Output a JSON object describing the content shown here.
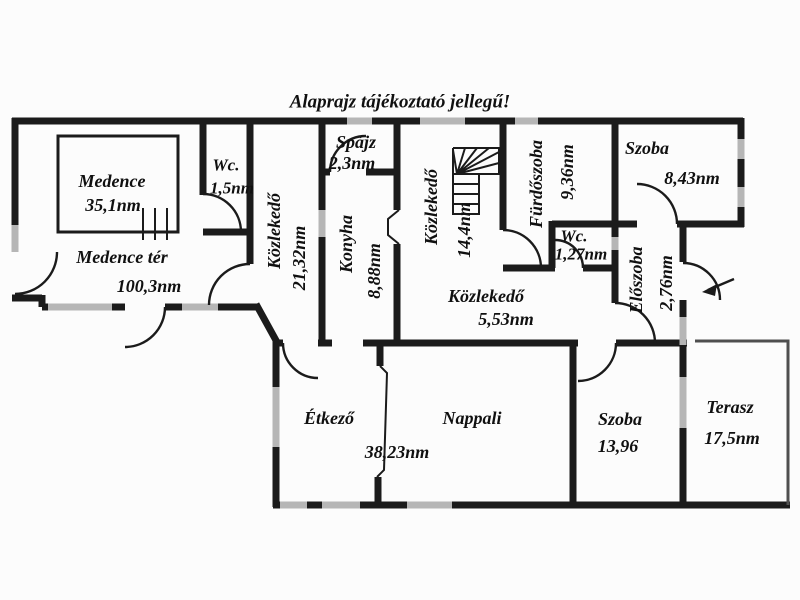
{
  "title": "Alaprajz tájékoztató jellegű!",
  "rooms": [
    {
      "name": "Medence",
      "area": "35,1nm"
    },
    {
      "name": "Medence tér",
      "area": "100,3nm"
    },
    {
      "name": "Wc.",
      "area": "1,5nm"
    },
    {
      "name": "Közlekedő",
      "area": "21,32nm"
    },
    {
      "name": "Spájz",
      "area": "2,3nm"
    },
    {
      "name": "Konyha",
      "area": "8,88nm"
    },
    {
      "name": "Közlekedő",
      "area": "14,4nm"
    },
    {
      "name": "Fürdőszoba",
      "area": "9,36nm"
    },
    {
      "name": "Wc.",
      "area": "1,27nm"
    },
    {
      "name": "Szoba",
      "area": "8,43nm"
    },
    {
      "name": "Előszoba",
      "area": "2,76nm"
    },
    {
      "name": "Közlekedő",
      "area": "5,53nm"
    },
    {
      "name": "Étkező",
      "area": ""
    },
    {
      "name": "Nappali",
      "area": "38,23nm"
    },
    {
      "name": "Szoba",
      "area": "13,96"
    },
    {
      "name": "Terasz",
      "area": "17,5nm"
    }
  ],
  "icons": {
    "stairs": "stairs-icon",
    "entrance_arrow": "entrance-arrow-icon",
    "pool_ladder": "pool-ladder-icon",
    "doors": "door-arc"
  },
  "colors": {
    "wall": "#1b1b1b",
    "window": "#b6b6b6",
    "background": "#fcfcfc",
    "text": "#101010"
  }
}
